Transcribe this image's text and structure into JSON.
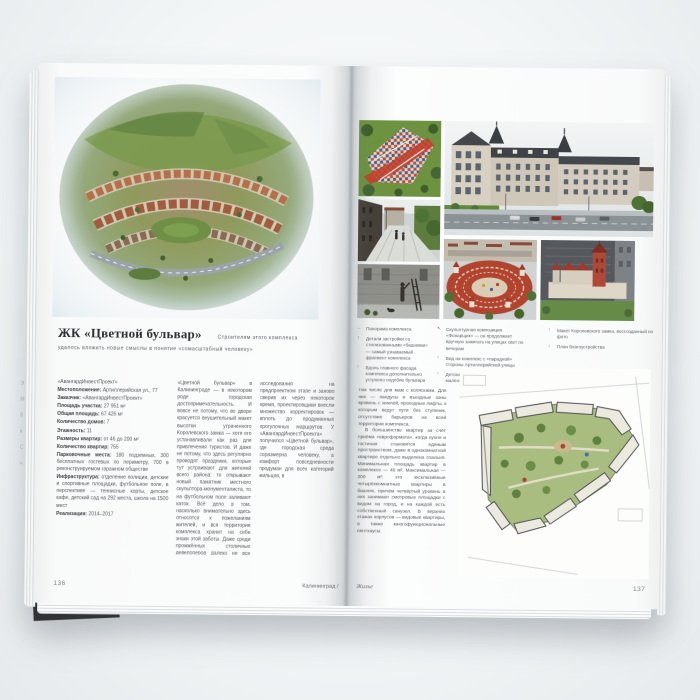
{
  "palette": {
    "page": "#f9fafa",
    "body_text": "#54585c",
    "title_text": "#2e3134",
    "photo_green": "#6e9340",
    "photo_terracotta": "#b2432e",
    "facade_beige": "#d6cfc0",
    "roof_dark": "#3f4347",
    "plan_green": "#a9bd80"
  },
  "left_page": {
    "page_number": "136",
    "running_footer": "Калининград /",
    "title": "ЖК «Цветной бульвар»",
    "subtitle_lead": "Строителям этого комплекса",
    "subtitle_rest": "удалось вложить новые смыслы в понятие «сомасштабный человеку»",
    "info": [
      {
        "label": "",
        "value": "«АвангардИнвестПроект»"
      },
      {
        "label": "Местоположение:",
        "value": "Артиллерийская ул., 77"
      },
      {
        "label": "Заказчик:",
        "value": "«АвангардИнвестПроект»"
      },
      {
        "label": "Площадь участка:",
        "value": "27 951 м²"
      },
      {
        "label": "Общая площадь:",
        "value": "67 426 м²"
      },
      {
        "label": "Количество домов:",
        "value": "7"
      },
      {
        "label": "Этажность:",
        "value": "11"
      },
      {
        "label": "Размеры квартир:",
        "value": "от 46 до 200 м²"
      },
      {
        "label": "Количество квартир:",
        "value": "755"
      },
      {
        "label": "Парковочные места:",
        "value": "180 подземных, 300 бесплатных гостевых по периметру, 700 в реконструируемом гаражном обществе"
      },
      {
        "label": "Инфраструктура:",
        "value": "отделение полиции, детские и спортивные площадки, футбольное поле, в перспективе — теннисные корты, детское кафе, детский сад на 292 места, школа на 1500 мест"
      },
      {
        "label": "Реализация:",
        "value": "2014–2017"
      }
    ],
    "column2": "«Цветной бульвар» в Калининграде — в некотором роде городская достопримечательность. И вовсе не потому, что во дворе красуется внушительный макет высотки утраченного Королевского замка — хотя его устанавливали как раз для привлечения туристов. И даже не потому, что здесь регулярно проводят праздники, которые тут устраивают для жителей всего района: то открывают новый памятник местного скульптора-монументалиста, то на футбольном поле заливают каток. Всё дело в том, насколько внимательно здесь относятся к пожеланиям жителей, и вся территория комплекса хранит на себе знаки этой заботы. Даже среди прожжённых столичных девелоперов далеко не все считают нужным уходить в «клиентоориентированное» проектирование таких микрорайонов. Проведя маркетинговые",
    "column3": "исследования на предпроектном этапе и заново сверив их через некоторое время, проектировщики внесли множество корректировок — вплоть до продуманных прогулочных маршрутов. У «АвангардИнвестПроекта» получился «Цветной бульвар», где городская среда соразмерна человеку, а комфорт повседневности продуман для всех категорий жильцов, в"
  },
  "right_page": {
    "page_number": "137",
    "running_footer": "Жилье",
    "captions": {
      "group_a": [
        {
          "arrow": "←",
          "text": "Панорама комплекса"
        },
        {
          "arrow": "↑",
          "text": "Детали застройки со стилизованными «башнями» — самый узнаваемый фрагмент комплекса"
        },
        {
          "arrow": "↑",
          "text": "Вдоль главного фасада комплекса дополнительно устроено подобие бульвара"
        }
      ],
      "group_b": [
        {
          "arrow": "↖",
          "text": "Скульптурная композиция «Фонарщик» — он продолжает вручную зажигать на улицах свет по вечерам"
        },
        {
          "arrow": "↑",
          "text": "Вид на комплекс с «парадной» стороны Артиллерийской улицы"
        },
        {
          "arrow": "↑",
          "text": "Детские площадки для самых маленьких"
        }
      ],
      "group_c": [
        {
          "arrow": "↑",
          "text": "Макет Королевского замка, воссозданный по фото"
        },
        {
          "arrow": "↓",
          "text": "План благоустройства"
        }
      ]
    },
    "body_p1": "том числе для мам с колясками. Для них — пандусы и въездные зоны вровень с землёй, проходные лифты, к которым ведут пути без ступенек, отсутствие барьеров на всей территории комплекса.",
    "body_p2": "В большинстве квартир за счёт приёма «евроформата», когда кухня и гостиная становятся единым пространством, даже в однокомнатной квартире отдельно выделена спальня. Минимальная площадь квартир в комплексе — 46 м². Максимальная — 200 м²: это эксклюзивные четырёхкомнатные квартиры в башнях, причём четвёртый уровень в них занимают смотровые площадки с видом на город, и на каждой есть собственный санузел. В верхних этажах корпусов — видовые квартиры, а также многофункциональные пентхаусы."
  },
  "edge_fragments": [
    "Э",
    "М",
    "б",
    "к",
    "С",
    "ч"
  ]
}
